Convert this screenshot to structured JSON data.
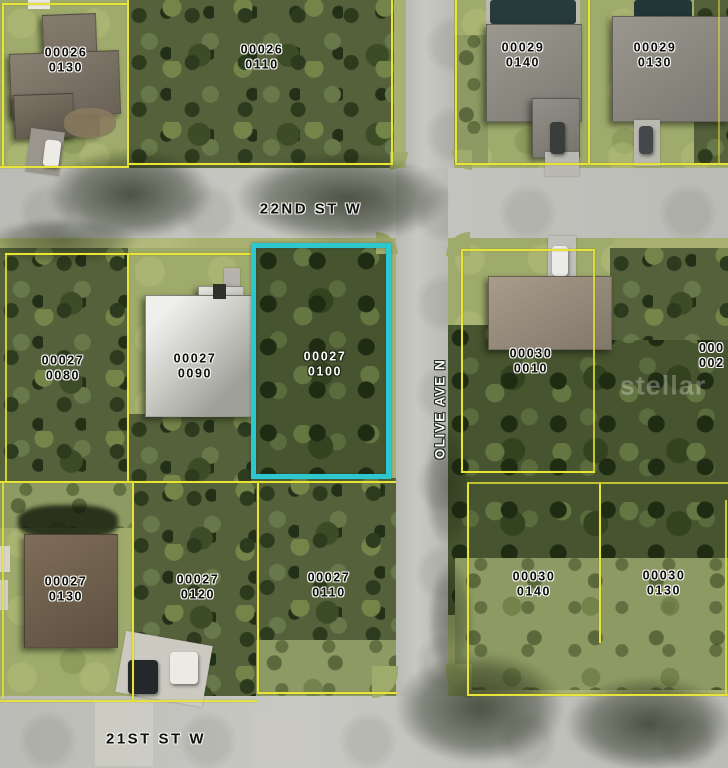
{
  "title": "Aerial parcel map with highlighted lot",
  "streets": {
    "s22nd": "22ND ST W",
    "s21st": "21ST ST W",
    "olive": "OLIVE AVE N"
  },
  "highlight": {
    "line1": "00027",
    "line2": "0100",
    "color": "#2cc7cf"
  },
  "partial_parcel_right": {
    "line1": "000",
    "line2": "002"
  },
  "watermark": {
    "text": "stellar"
  },
  "colors": {
    "parcel_line": "#e9e43a",
    "highlight": "#2cc7cf",
    "road": "#c4c5bf",
    "grass": "#a9b172"
  },
  "parcels": [
    {
      "id": "00026-0130",
      "line1": "00026",
      "line2": "0130"
    },
    {
      "id": "00026-0110",
      "line1": "00026",
      "line2": "0110"
    },
    {
      "id": "00029-0140",
      "line1": "00029",
      "line2": "0140"
    },
    {
      "id": "00029-0130",
      "line1": "00029",
      "line2": "0130"
    },
    {
      "id": "00027-0080",
      "line1": "00027",
      "line2": "0080"
    },
    {
      "id": "00027-0090",
      "line1": "00027",
      "line2": "0090"
    },
    {
      "id": "00030-0010",
      "line1": "00030",
      "line2": "0010"
    },
    {
      "id": "00027-0130",
      "line1": "00027",
      "line2": "0130"
    },
    {
      "id": "00027-0120",
      "line1": "00027",
      "line2": "0120"
    },
    {
      "id": "00027-0110",
      "line1": "00027",
      "line2": "0110"
    },
    {
      "id": "00030-0140",
      "line1": "00030",
      "line2": "0140"
    },
    {
      "id": "00030-0130",
      "line1": "00030",
      "line2": "0130"
    }
  ]
}
